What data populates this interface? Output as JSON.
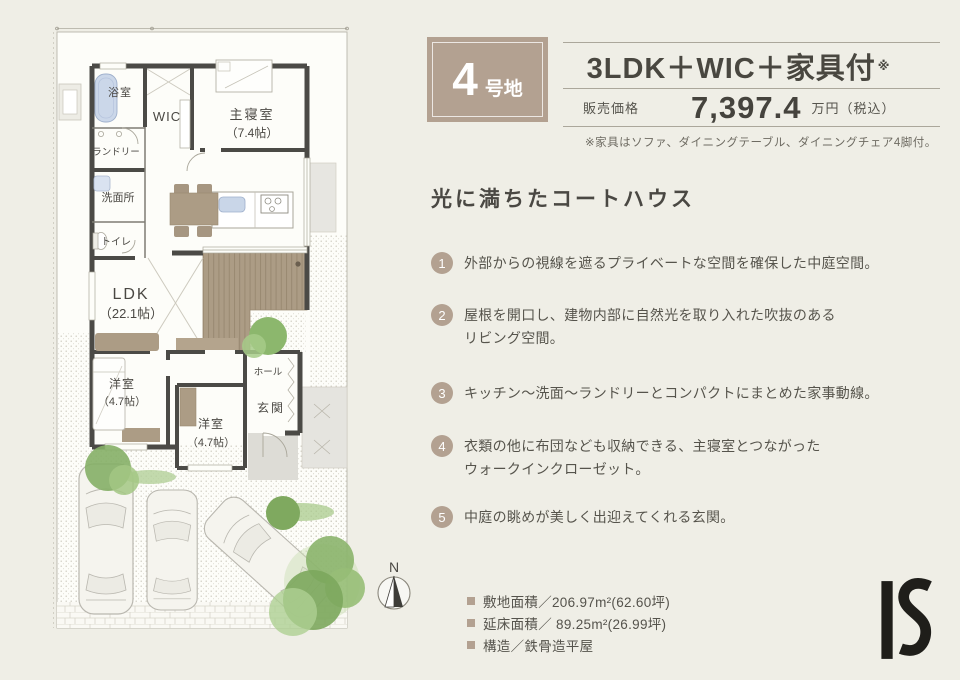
{
  "colors": {
    "accent": "#B3A191",
    "background": "#EFEEE6",
    "wall": "#4B4A46",
    "deck_wood": "#AC9C85",
    "tree_green": "#8CB76D",
    "text": "#4A4843",
    "logo_black": "#1F1E1A"
  },
  "header": {
    "lot_badge": {
      "number": "4",
      "suffix": "号地"
    },
    "layout_title": "3LDK＋WIC＋家具付",
    "layout_note_mark": "※",
    "price_label": "販売価格",
    "price_value": "7,397.4",
    "price_unit": "万円（税込）",
    "furniture_note": "※家具はソファ、ダイニングテーブル、ダイニングチェア4脚付。"
  },
  "concept": {
    "title": "光に満ちたコートハウス",
    "features": [
      {
        "num": "1",
        "lines": [
          "外部からの視線を遮るプライベートな空間を確保した中庭空間。",
          ""
        ]
      },
      {
        "num": "2",
        "lines": [
          "屋根を開口し、建物内部に自然光を取り入れた吹抜のある",
          "リビング空間。"
        ]
      },
      {
        "num": "3",
        "lines": [
          "キッチン～洗面～ランドリーとコンパクトにまとめた家事動線。",
          ""
        ]
      },
      {
        "num": "4",
        "lines": [
          "衣類の他に布団なども収納できる、主寝室とつながった",
          "ウォークインクローゼット。"
        ]
      },
      {
        "num": "5",
        "lines": [
          "中庭の眺めが美しく出迎えてくれる玄関。",
          ""
        ]
      }
    ]
  },
  "specs": {
    "items": [
      "敷地面積／206.97m²(62.60坪)",
      "延床面積／ 89.25m²(26.99坪)",
      "構造／鉄骨造平屋"
    ]
  },
  "floor_plan": {
    "rooms": {
      "bath": "浴室",
      "wic": "WIC",
      "master": "主寝室",
      "master_size": "（7.4帖）",
      "laundry": "ランドリー",
      "washroom": "洗面所",
      "toilet": "トイレ",
      "ldk": "LDK",
      "ldk_size": "（22.1帖）",
      "west_room_1": "洋室",
      "west_room_1_size": "（4.7帖）",
      "west_room_2": "洋室",
      "west_room_2_size": "（4.7帖）",
      "hall": "ホール",
      "entrance": "玄関"
    },
    "compass": "N"
  },
  "logo_text": "IS"
}
